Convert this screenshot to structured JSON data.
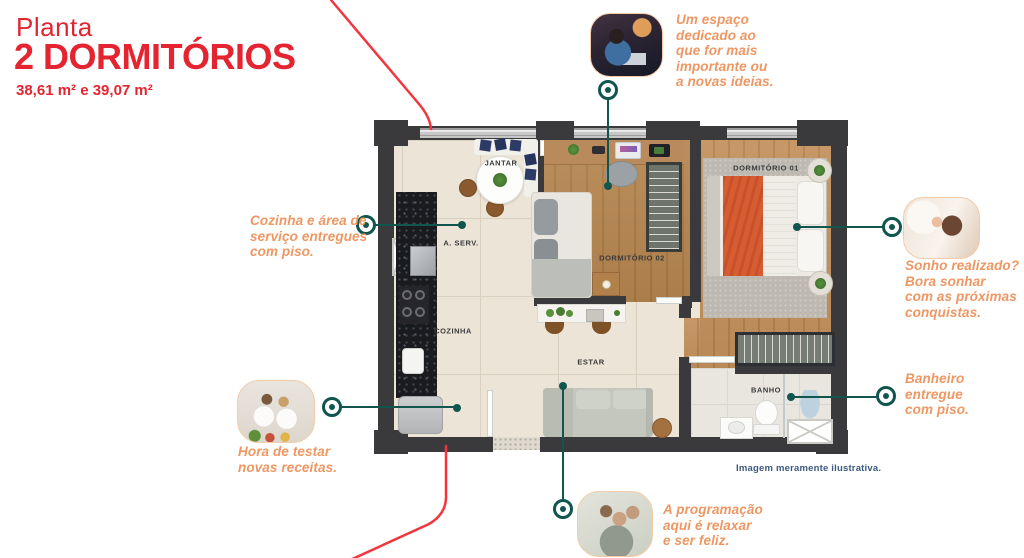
{
  "header": {
    "kicker": "Planta",
    "title": "2 DORMITÓRIOS",
    "areas": "38,61 m² e 39,07 m²"
  },
  "plan": {
    "rooms": {
      "jantar": "JANTAR",
      "aserv": "A. SERV.",
      "cozinha": "COZINHA",
      "estar": "ESTAR",
      "dorm02": "DORMITÓRIO 02",
      "dorm01": "DORMITÓRIO 01",
      "banho": "BANHO"
    }
  },
  "callouts": [
    {
      "id": "workspace",
      "photo": "man-working-at-laptop",
      "text": "Um espaço\ndedicado ao\nque for mais\nimportante ou\na novas ideias."
    },
    {
      "id": "kitchen-floor",
      "text": "Cozinha e área de\nserviço entregues\ncom piso."
    },
    {
      "id": "dream",
      "photo": "woman-waking-up-in-bed",
      "text": "Sonho realizado?\nBora sonhar\ncom as próximas\nconquistas."
    },
    {
      "id": "bathroom-floor",
      "text": "Banheiro\nentregue\ncom piso."
    },
    {
      "id": "recipes",
      "photo": "couple-cooking-together",
      "text": "Hora de testar\nnovas receitas."
    },
    {
      "id": "relax",
      "photo": "man-relaxing-on-sofa",
      "text": "A programação\naqui é relaxar\ne ser feliz."
    }
  ],
  "caption": "Imagem meramente ilustrativa.",
  "colors": {
    "brand_red": "#e52431",
    "curve_red": "#f2353e",
    "accent_orange": "#ee9763",
    "line_teal": "#10564e",
    "caption_blue": "#3b5a7d",
    "wall": "#3a393b"
  }
}
